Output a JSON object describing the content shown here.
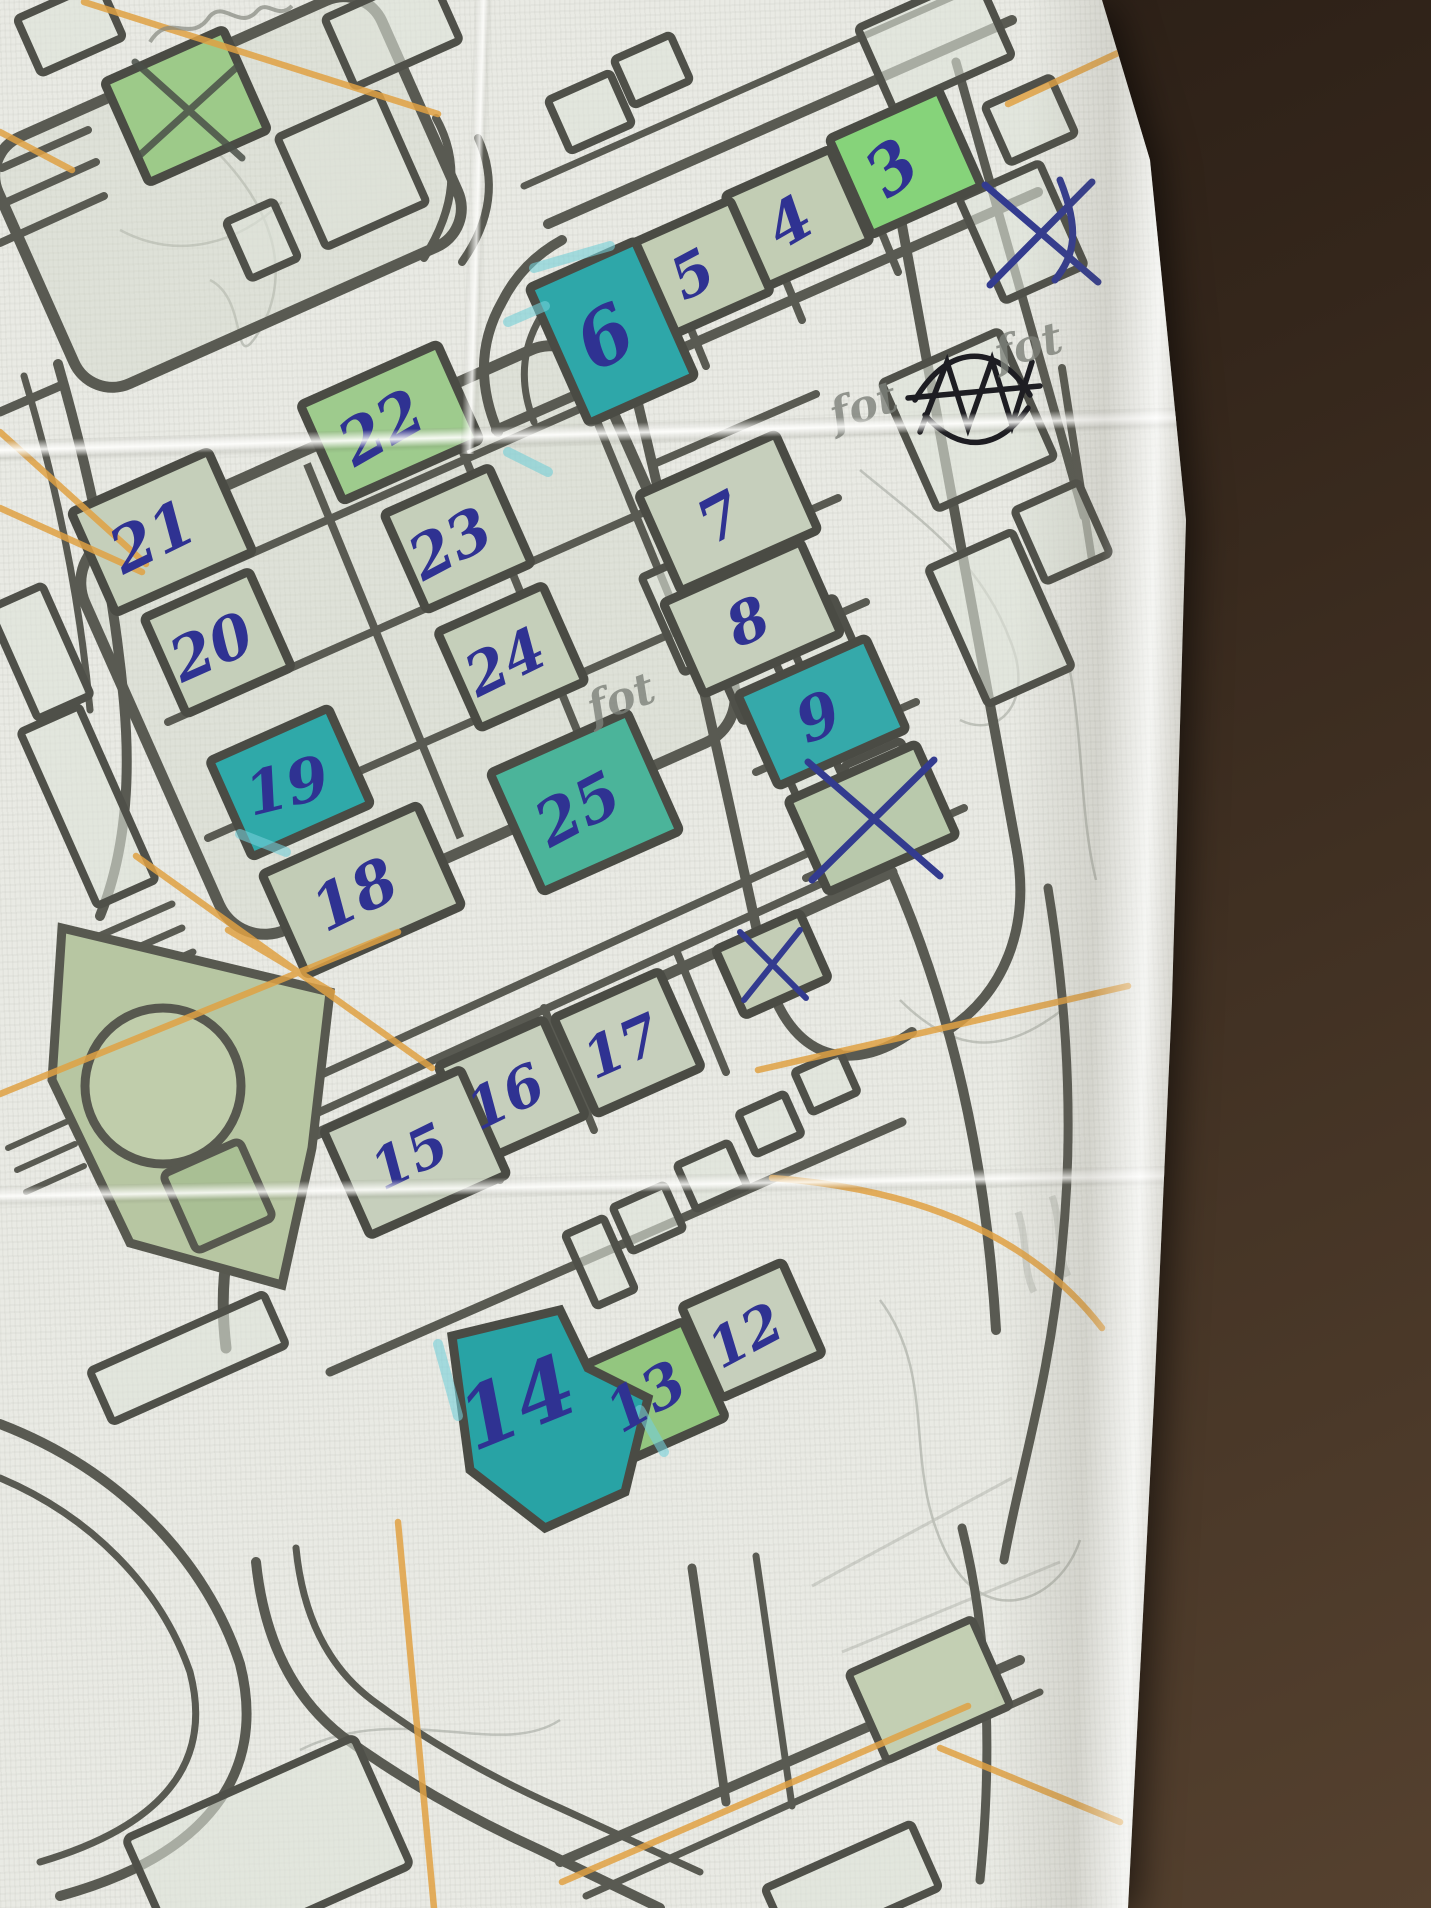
{
  "scene": {
    "type": "photo of a printed street map with handwritten route marks",
    "surface_color": "#34261b",
    "paper_color": "#e9eae4"
  },
  "map": {
    "street_color": "#595a52",
    "pen_color": "#2f3292",
    "orange_pencil_color": "#e0a143",
    "highlight_colors": {
      "teal": "#2ea7a9",
      "bright_green": "#86d37a",
      "green": "#9ecb8d",
      "sage": "#c9d2bf"
    }
  },
  "buildings": [
    {
      "label": "3",
      "highlight": "bright_green",
      "crossed_out": false
    },
    {
      "label": "4",
      "highlight": "sage",
      "crossed_out": false
    },
    {
      "label": "5",
      "highlight": "sage",
      "crossed_out": false
    },
    {
      "label": "6",
      "highlight": "teal",
      "crossed_out": false
    },
    {
      "label": "7",
      "highlight": "sage",
      "crossed_out": false
    },
    {
      "label": "8",
      "highlight": "sage",
      "crossed_out": false
    },
    {
      "label": "9",
      "highlight": "teal",
      "crossed_out": false
    },
    {
      "label": "",
      "highlight": "sage",
      "crossed_out": true
    },
    {
      "label": "",
      "highlight": "sage",
      "crossed_out": true
    },
    {
      "label": "21",
      "highlight": "sage",
      "crossed_out": false
    },
    {
      "label": "22",
      "highlight": "green",
      "crossed_out": false
    },
    {
      "label": "23",
      "highlight": "sage",
      "crossed_out": false
    },
    {
      "label": "24",
      "highlight": "sage",
      "crossed_out": false
    },
    {
      "label": "20",
      "highlight": "sage",
      "crossed_out": false
    },
    {
      "label": "19",
      "highlight": "teal",
      "crossed_out": false
    },
    {
      "label": "18",
      "highlight": "sage",
      "crossed_out": false
    },
    {
      "label": "25",
      "highlight": "teal",
      "crossed_out": false
    },
    {
      "label": "17",
      "highlight": "sage",
      "crossed_out": false
    },
    {
      "label": "16",
      "highlight": "sage",
      "crossed_out": false
    },
    {
      "label": "15",
      "highlight": "sage",
      "crossed_out": false
    },
    {
      "label": "12",
      "highlight": "sage",
      "crossed_out": false
    },
    {
      "label": "13",
      "highlight": "green",
      "crossed_out": false
    },
    {
      "label": "14",
      "highlight": "teal",
      "crossed_out": false
    },
    {
      "label": "",
      "highlight": "green",
      "crossed_out": true
    }
  ],
  "annotations": {
    "pencil_notes": [
      {
        "text": "fot"
      },
      {
        "text": "fot"
      },
      {
        "text": "fot"
      }
    ],
    "pen_x_marks": [
      {
        "location": "green building, top-left block"
      },
      {
        "location": "paper margin, top-right"
      },
      {
        "location": "building below 9"
      },
      {
        "location": "small building above 17"
      }
    ],
    "pen_scribble": {
      "location": "top-right",
      "text": "illegible crossed-out word"
    }
  }
}
